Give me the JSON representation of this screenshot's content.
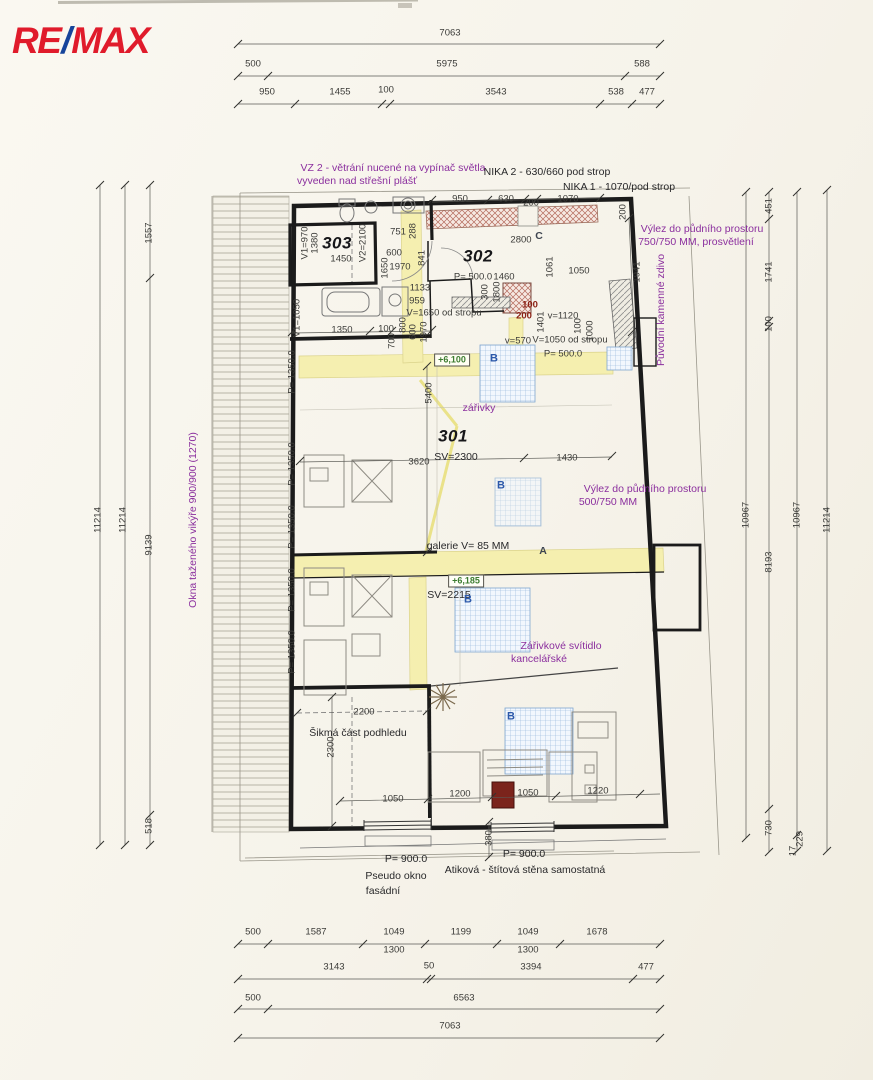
{
  "logo": {
    "re": "RE",
    "slash": "/",
    "max": "MAX"
  },
  "colors": {
    "logo_red": "#e01b2b",
    "logo_blue": "#16449a",
    "highlight_yellow": "#f5efa8",
    "annotation_purple": "#8b2f9e",
    "level_green": "#3c7c30",
    "nika_hatch_red": "#b46a5c",
    "skylight_blue": "#8fb3d9"
  },
  "rooms": [
    {
      "number": "303",
      "labels": [
        "V1=970",
        "1380",
        "V2=2100",
        "1450"
      ]
    },
    {
      "number": "302",
      "labels": [
        "P= 500.0",
        "1460",
        "2800",
        "C"
      ]
    },
    {
      "number": "301",
      "labels": [
        "SV=2300",
        "SV=2215"
      ]
    }
  ],
  "labels": [
    {
      "t": "7063",
      "x": 450,
      "y": 33
    },
    {
      "t": "500",
      "x": 253,
      "y": 64
    },
    {
      "t": "5975",
      "x": 447,
      "y": 64
    },
    {
      "t": "588",
      "x": 642,
      "y": 64
    },
    {
      "t": "950",
      "x": 267,
      "y": 92
    },
    {
      "t": "1455",
      "x": 340,
      "y": 92
    },
    {
      "t": "100",
      "x": 386,
      "y": 90
    },
    {
      "t": "3543",
      "x": 496,
      "y": 92
    },
    {
      "t": "538",
      "x": 616,
      "y": 92
    },
    {
      "t": "477",
      "x": 647,
      "y": 92
    },
    {
      "t": "500",
      "x": 253,
      "y": 932
    },
    {
      "t": "1587",
      "x": 316,
      "y": 932
    },
    {
      "t": "1049",
      "x": 394,
      "y": 932
    },
    {
      "t": "1199",
      "x": 461,
      "y": 932
    },
    {
      "t": "1049",
      "x": 528,
      "y": 932
    },
    {
      "t": "1678",
      "x": 597,
      "y": 932
    },
    {
      "t": "1300",
      "x": 394,
      "y": 950
    },
    {
      "t": "1300",
      "x": 528,
      "y": 950
    },
    {
      "t": "3143",
      "x": 334,
      "y": 967
    },
    {
      "t": "50",
      "x": 429,
      "y": 966
    },
    {
      "t": "3394",
      "x": 531,
      "y": 967
    },
    {
      "t": "477",
      "x": 646,
      "y": 967
    },
    {
      "t": "500",
      "x": 253,
      "y": 998
    },
    {
      "t": "6563",
      "x": 464,
      "y": 998
    },
    {
      "t": "7063",
      "x": 450,
      "y": 1026
    },
    {
      "t": "11214",
      "x": 98,
      "y": 520,
      "r": -90
    },
    {
      "t": "11214",
      "x": 123,
      "y": 520,
      "r": -90
    },
    {
      "t": "1557",
      "x": 149,
      "y": 233,
      "r": -90
    },
    {
      "t": "9139",
      "x": 149,
      "y": 545,
      "r": -90
    },
    {
      "t": "518",
      "x": 149,
      "y": 826,
      "r": -90
    },
    {
      "t": "Okna taženého vikýře 900/900 (1270)",
      "x": 193,
      "y": 520,
      "r": -90,
      "c": "purple"
    },
    {
      "t": "10967",
      "x": 746,
      "y": 515,
      "r": -90
    },
    {
      "t": "451",
      "x": 769,
      "y": 206,
      "r": -90
    },
    {
      "t": "1741",
      "x": 769,
      "y": 272,
      "r": -90
    },
    {
      "t": "100",
      "x": 769,
      "y": 324,
      "r": -90
    },
    {
      "t": "8193",
      "x": 769,
      "y": 562,
      "r": -90
    },
    {
      "t": "730",
      "x": 769,
      "y": 828,
      "r": -90
    },
    {
      "t": "10967",
      "x": 797,
      "y": 515,
      "r": -90
    },
    {
      "t": "229",
      "x": 800,
      "y": 839,
      "r": -90
    },
    {
      "t": "17",
      "x": 793,
      "y": 851,
      "r": -90
    },
    {
      "t": "11214",
      "x": 827,
      "y": 520,
      "r": -90
    },
    {
      "t": "VZ 2 - větrání nucené na vypínač světla",
      "x": 393,
      "y": 168,
      "c": "purple"
    },
    {
      "t": "vyveden nad střešní plášť",
      "x": 357,
      "y": 181,
      "c": "purple"
    },
    {
      "t": "NIKA 2 - 630/660 pod strop",
      "x": 547,
      "y": 172,
      "c": "note"
    },
    {
      "t": "NIKA 1 - 1070/pod strop",
      "x": 619,
      "y": 187,
      "c": "note"
    },
    {
      "t": "Výlez do půdního prostoru",
      "x": 702,
      "y": 229,
      "c": "purple"
    },
    {
      "t": "750/750 MM, prosvětlení",
      "x": 696,
      "y": 242,
      "c": "purple"
    },
    {
      "t": "Původní kamenné zdivo",
      "x": 661,
      "y": 310,
      "r": -90,
      "c": "purple"
    },
    {
      "t": "zářivky",
      "x": 479,
      "y": 408,
      "c": "purple"
    },
    {
      "t": "Výlez do půdního prostoru",
      "x": 645,
      "y": 489,
      "c": "purple"
    },
    {
      "t": "500/750 MM",
      "x": 608,
      "y": 502,
      "c": "purple"
    },
    {
      "t": "Zářivkové svítidlo",
      "x": 561,
      "y": 646,
      "c": "purple"
    },
    {
      "t": "kancelářské",
      "x": 539,
      "y": 659,
      "c": "purple"
    },
    {
      "t": "303",
      "x": 337,
      "y": 243,
      "c": "room"
    },
    {
      "t": "302",
      "x": 478,
      "y": 256,
      "c": "room"
    },
    {
      "t": "301",
      "x": 453,
      "y": 436,
      "c": "room"
    },
    {
      "t": "SV=2300",
      "x": 456,
      "y": 457,
      "c": "note"
    },
    {
      "t": "SV=2215",
      "x": 449,
      "y": 595,
      "c": "note"
    },
    {
      "t": "galerie V= 85 MM",
      "x": 468,
      "y": 546,
      "c": "note"
    },
    {
      "t": "Šikmá část podhledu",
      "x": 358,
      "y": 733,
      "c": "note"
    },
    {
      "t": "P= 900.0",
      "x": 406,
      "y": 859,
      "c": "note"
    },
    {
      "t": "Pseudo okno",
      "x": 396,
      "y": 876,
      "c": "note"
    },
    {
      "t": "fasádní",
      "x": 383,
      "y": 891,
      "c": "note"
    },
    {
      "t": "P= 900.0",
      "x": 524,
      "y": 854,
      "c": "note"
    },
    {
      "t": "Atiková - štítová stěna samostatná",
      "x": 525,
      "y": 870,
      "c": "note"
    },
    {
      "t": "+6,100",
      "x": 452,
      "y": 360,
      "c": "green"
    },
    {
      "t": "+6,185",
      "x": 466,
      "y": 581,
      "c": "green"
    },
    {
      "t": "A",
      "x": 543,
      "y": 551,
      "c": "letter"
    },
    {
      "t": "C",
      "x": 539,
      "y": 236,
      "c": "letter"
    },
    {
      "t": "B",
      "x": 494,
      "y": 359,
      "c": "blue"
    },
    {
      "t": "B",
      "x": 501,
      "y": 486,
      "c": "blue"
    },
    {
      "t": "B",
      "x": 468,
      "y": 600,
      "c": "blue"
    },
    {
      "t": "B",
      "x": 511,
      "y": 717,
      "c": "blue"
    },
    {
      "t": "950",
      "x": 460,
      "y": 199
    },
    {
      "t": "630",
      "x": 506,
      "y": 199
    },
    {
      "t": "200",
      "x": 531,
      "y": 203
    },
    {
      "t": "1070",
      "x": 568,
      "y": 199
    },
    {
      "t": "200",
      "x": 623,
      "y": 212,
      "r": -90
    },
    {
      "t": "1941",
      "x": 637,
      "y": 272,
      "r": -90
    },
    {
      "t": "2800",
      "x": 521,
      "y": 240
    },
    {
      "t": "1061",
      "x": 550,
      "y": 267,
      "r": -90
    },
    {
      "t": "1050",
      "x": 579,
      "y": 271
    },
    {
      "t": "751",
      "x": 398,
      "y": 232
    },
    {
      "t": "288",
      "x": 413,
      "y": 231,
      "r": -90
    },
    {
      "t": "600",
      "x": 394,
      "y": 253
    },
    {
      "t": "1970",
      "x": 400,
      "y": 267
    },
    {
      "t": "841",
      "x": 422,
      "y": 258,
      "r": -90
    },
    {
      "t": "1650",
      "x": 385,
      "y": 268,
      "r": -90
    },
    {
      "t": "V1=970",
      "x": 305,
      "y": 243,
      "r": -90
    },
    {
      "t": "1380",
      "x": 315,
      "y": 243,
      "r": -90
    },
    {
      "t": "V2=2100",
      "x": 363,
      "y": 243,
      "r": -90
    },
    {
      "t": "1450",
      "x": 341,
      "y": 259
    },
    {
      "t": "P= 500.0",
      "x": 473,
      "y": 277
    },
    {
      "t": "1460",
      "x": 504,
      "y": 277
    },
    {
      "t": "1133",
      "x": 420,
      "y": 288
    },
    {
      "t": "959",
      "x": 417,
      "y": 301
    },
    {
      "t": "V=1650 od stropu",
      "x": 444,
      "y": 313
    },
    {
      "t": "300",
      "x": 485,
      "y": 292,
      "r": -90
    },
    {
      "t": "1800",
      "x": 497,
      "y": 292,
      "r": -90
    },
    {
      "t": "100",
      "x": 530,
      "y": 305,
      "c": "red"
    },
    {
      "t": "200",
      "x": 524,
      "y": 316,
      "c": "red"
    },
    {
      "t": "1401",
      "x": 541,
      "y": 322,
      "r": -90
    },
    {
      "t": "v=1120",
      "x": 563,
      "y": 316
    },
    {
      "t": "100",
      "x": 578,
      "y": 326,
      "r": -90
    },
    {
      "t": "1000",
      "x": 590,
      "y": 331,
      "r": -90
    },
    {
      "t": "V=1050 od stropu",
      "x": 570,
      "y": 340
    },
    {
      "t": "P= 500.0",
      "x": 563,
      "y": 354
    },
    {
      "t": "v=570",
      "x": 518,
      "y": 341
    },
    {
      "t": "V1=1050",
      "x": 297,
      "y": 318,
      "r": -90
    },
    {
      "t": "1350",
      "x": 342,
      "y": 330
    },
    {
      "t": "100",
      "x": 386,
      "y": 329
    },
    {
      "t": "700",
      "x": 392,
      "y": 341,
      "r": -90
    },
    {
      "t": "800",
      "x": 403,
      "y": 325,
      "r": -90
    },
    {
      "t": "600",
      "x": 413,
      "y": 332,
      "r": -90
    },
    {
      "t": "1970",
      "x": 424,
      "y": 332,
      "r": -90
    },
    {
      "t": "P= 1350.0",
      "x": 292,
      "y": 372,
      "r": -90
    },
    {
      "t": "P= 1350.0",
      "x": 292,
      "y": 464,
      "r": -90
    },
    {
      "t": "P= 1350.0",
      "x": 292,
      "y": 527,
      "r": -90
    },
    {
      "t": "P= 1350.0",
      "x": 292,
      "y": 590,
      "r": -90
    },
    {
      "t": "P= 1350.0",
      "x": 292,
      "y": 652,
      "r": -90
    },
    {
      "t": "5400",
      "x": 429,
      "y": 393,
      "r": -90
    },
    {
      "t": "3620",
      "x": 419,
      "y": 462
    },
    {
      "t": "1430",
      "x": 567,
      "y": 458
    },
    {
      "t": "2200",
      "x": 364,
      "y": 712
    },
    {
      "t": "2300",
      "x": 331,
      "y": 747,
      "r": -90
    },
    {
      "t": "1050",
      "x": 393,
      "y": 799
    },
    {
      "t": "1200",
      "x": 460,
      "y": 794
    },
    {
      "t": "1050",
      "x": 528,
      "y": 793
    },
    {
      "t": "1220",
      "x": 598,
      "y": 791
    },
    {
      "t": "380",
      "x": 489,
      "y": 838,
      "r": -90
    }
  ]
}
